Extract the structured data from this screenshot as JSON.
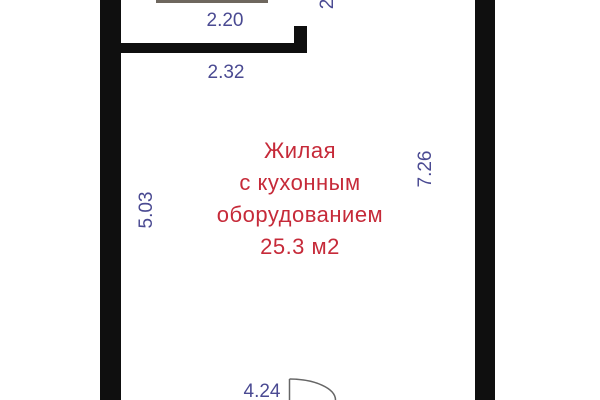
{
  "room": {
    "name_lines": [
      "Жилая",
      "с кухонным",
      "оборудованием"
    ],
    "area": "25.3 м2"
  },
  "dimensions": {
    "top": "2.20",
    "top_secondary": "2.32",
    "left": "5.03",
    "right": "7.26",
    "bottom": "4.24",
    "top_right_partial": "2"
  },
  "colors": {
    "wall": "#0f0f0f",
    "dimension_text": "#4a4a92",
    "room_text": "#c62a39",
    "door_arc": "#666666",
    "background": "#ffffff"
  }
}
